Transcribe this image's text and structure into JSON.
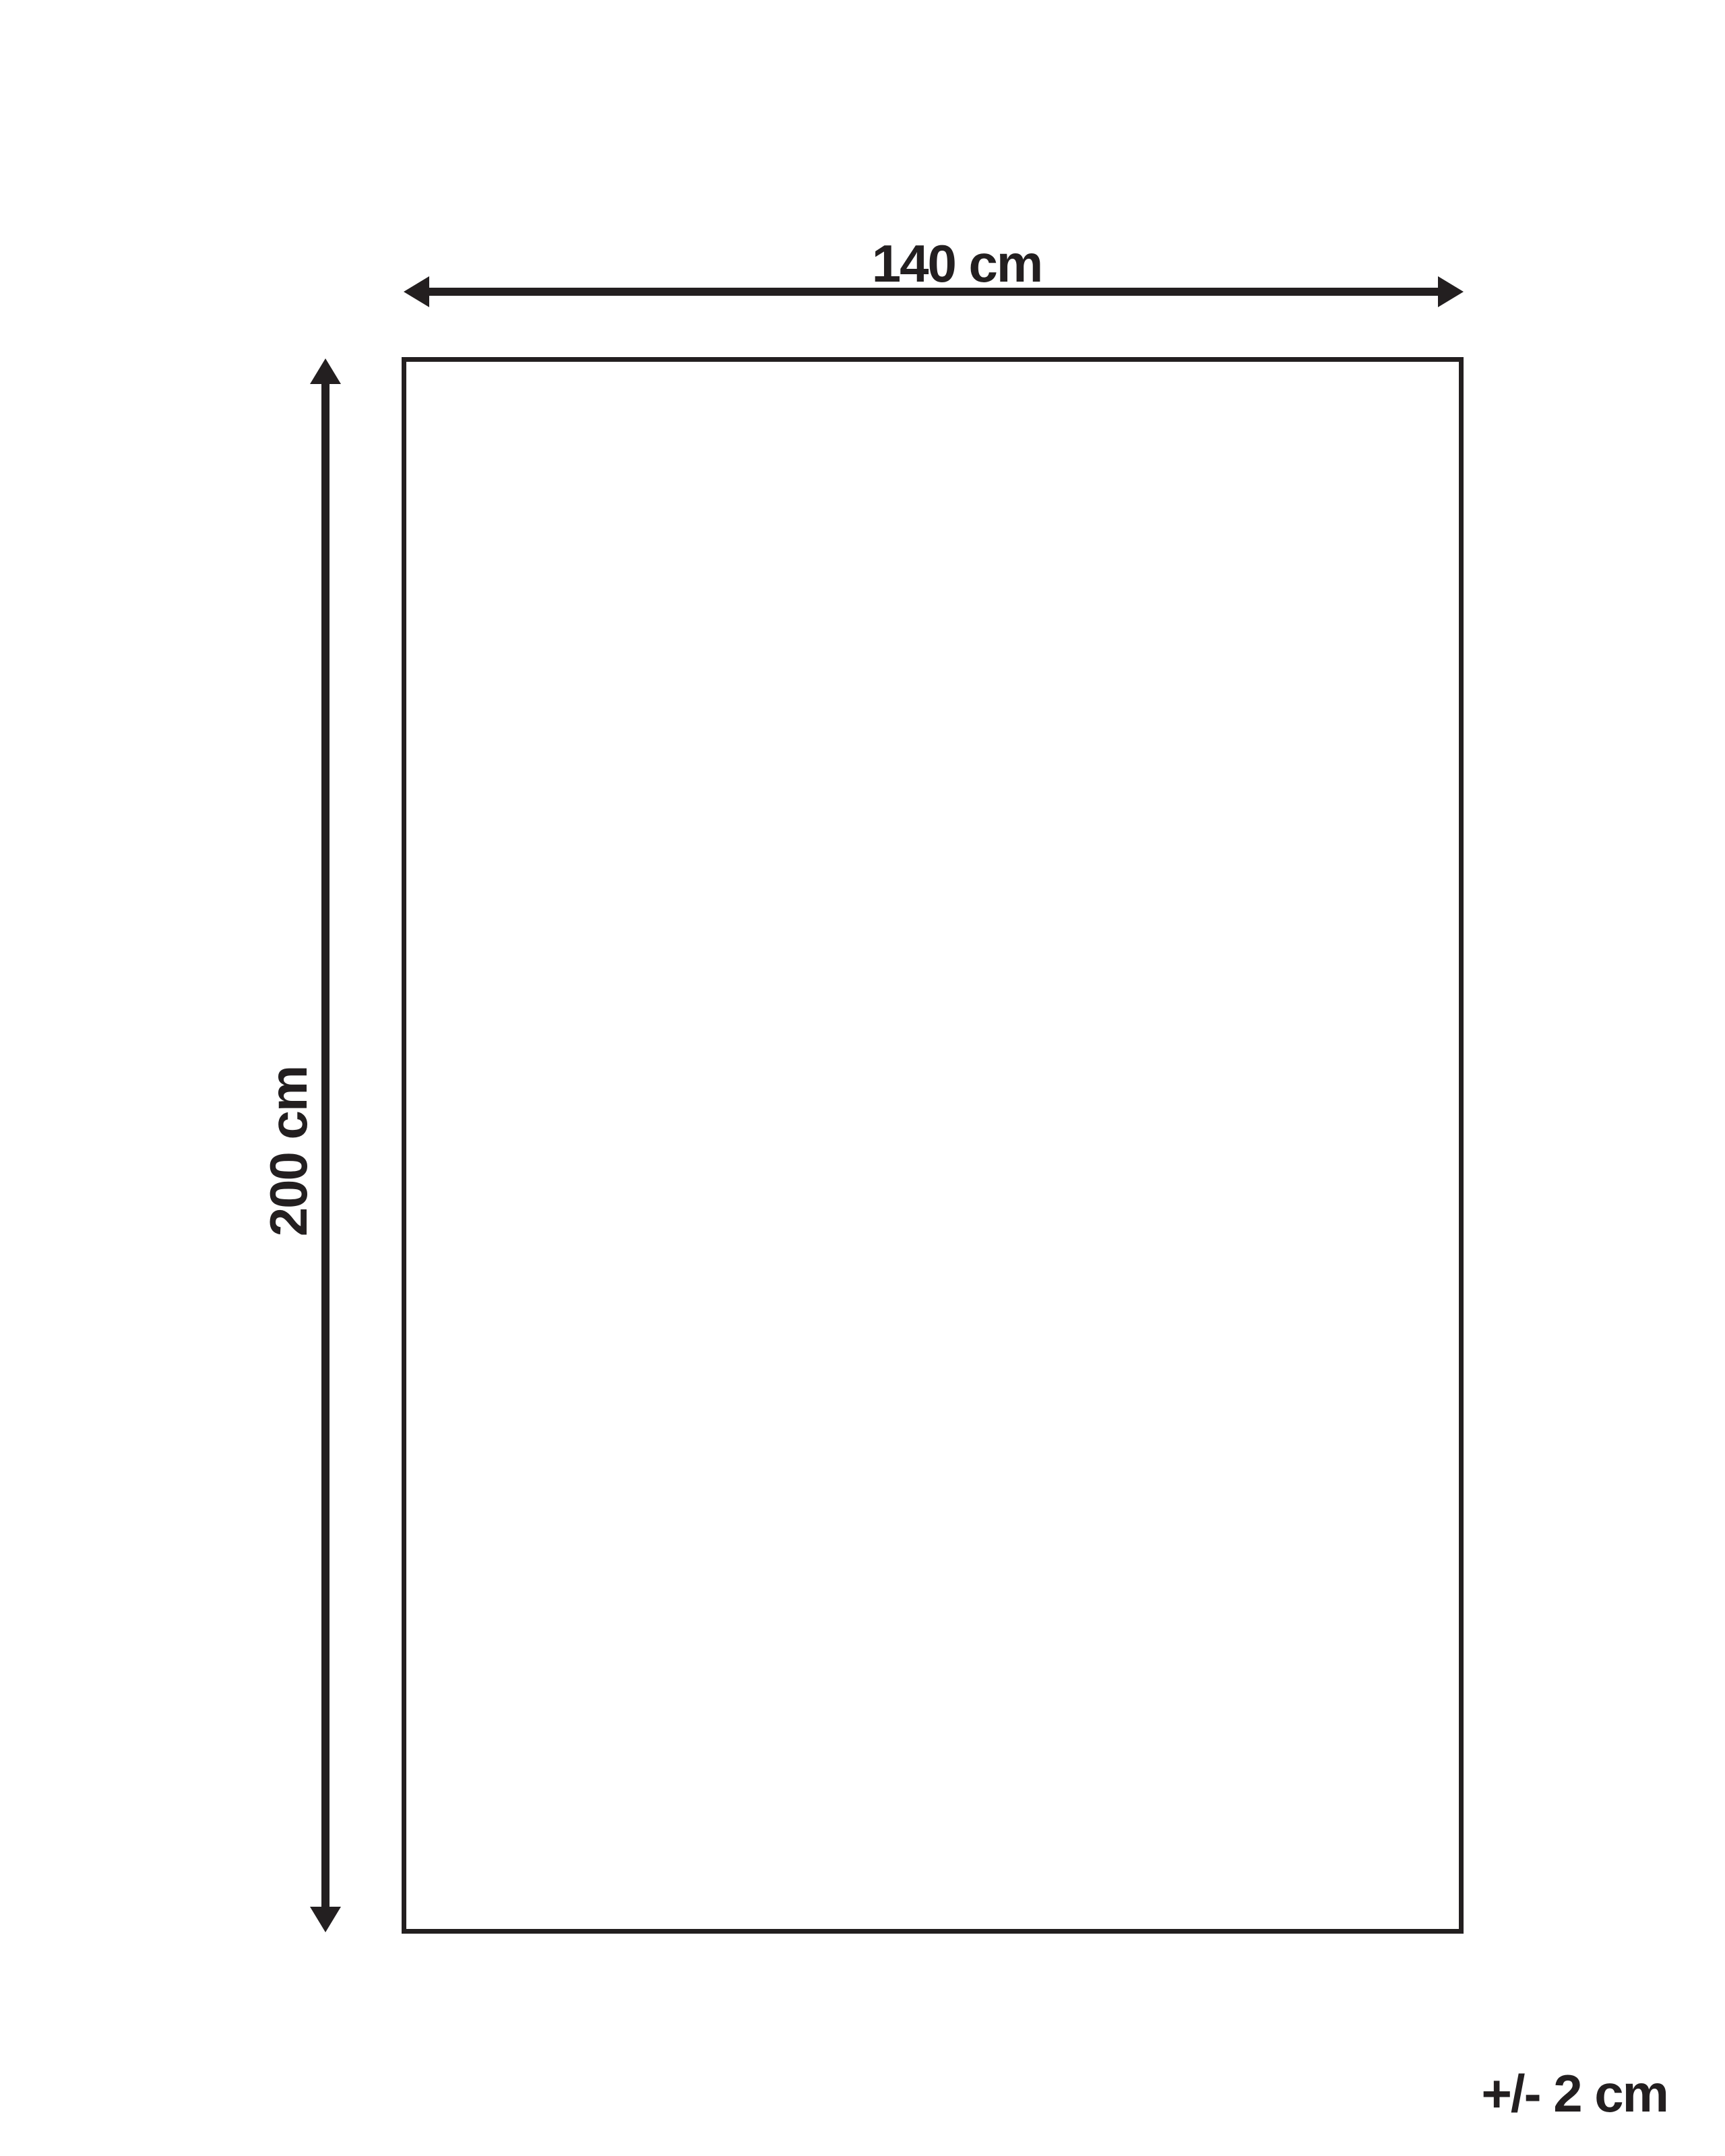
{
  "page": {
    "background_color": "#ffffff",
    "ink_color": "#231f20"
  },
  "diagram": {
    "type": "product-dimension-diagram",
    "width_dimension": {
      "label": "140 cm"
    },
    "height_dimension": {
      "label": "200 cm"
    },
    "tolerance": {
      "label": "+/- 2 cm"
    }
  }
}
